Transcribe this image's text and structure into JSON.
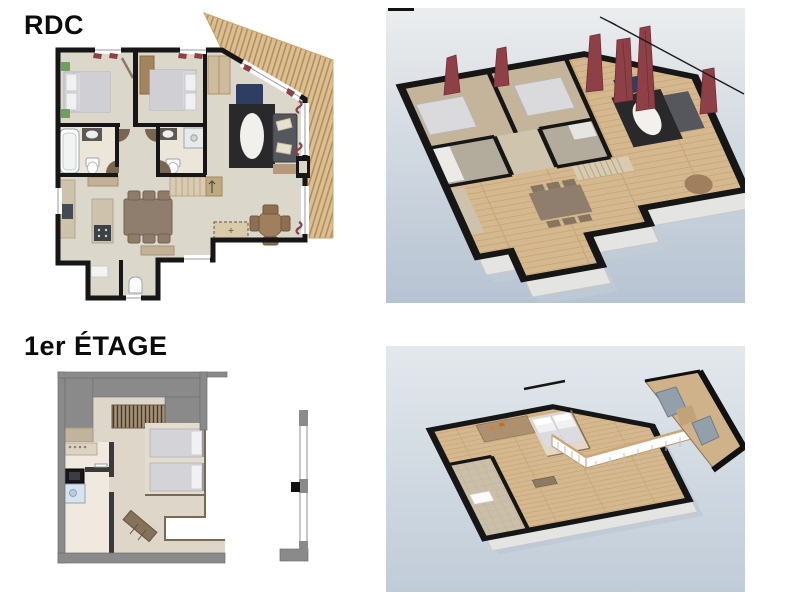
{
  "page": {
    "background": "#ffffff"
  },
  "floors": [
    {
      "id": "rdc",
      "label": "RDC",
      "plan2d_name": "ground-floor-2d-plan",
      "view3d_name": "ground-floor-3d-view"
    },
    {
      "id": "etage1",
      "label": "1er ÉTAGE",
      "plan2d_name": "first-floor-2d-plan",
      "view3d_name": "first-floor-3d-view"
    }
  ],
  "colors": {
    "page-bg": "#ffffff",
    "wall": "#161616",
    "floor": "#dcd7cb",
    "bath-floor": "#ebe5da",
    "deck": "#dbbf92",
    "deck-stripe": "#ae8c5b",
    "gray-wall": "#8a8a8a",
    "curtain": "#8e4046",
    "rug": "#29292b",
    "sofa": "#56575c",
    "armchair": "#2e3e62",
    "green": "#6f9f60",
    "wood": "#a07f5e",
    "slab": "#e4e4e2",
    "wood-floor-3d": "#d6b88e",
    "sky-top": "#ebedee",
    "sky-bottom": "#b6c3d2",
    "sky2-top": "#e3e8ec",
    "sky2-bottom": "#c0ccd8"
  }
}
